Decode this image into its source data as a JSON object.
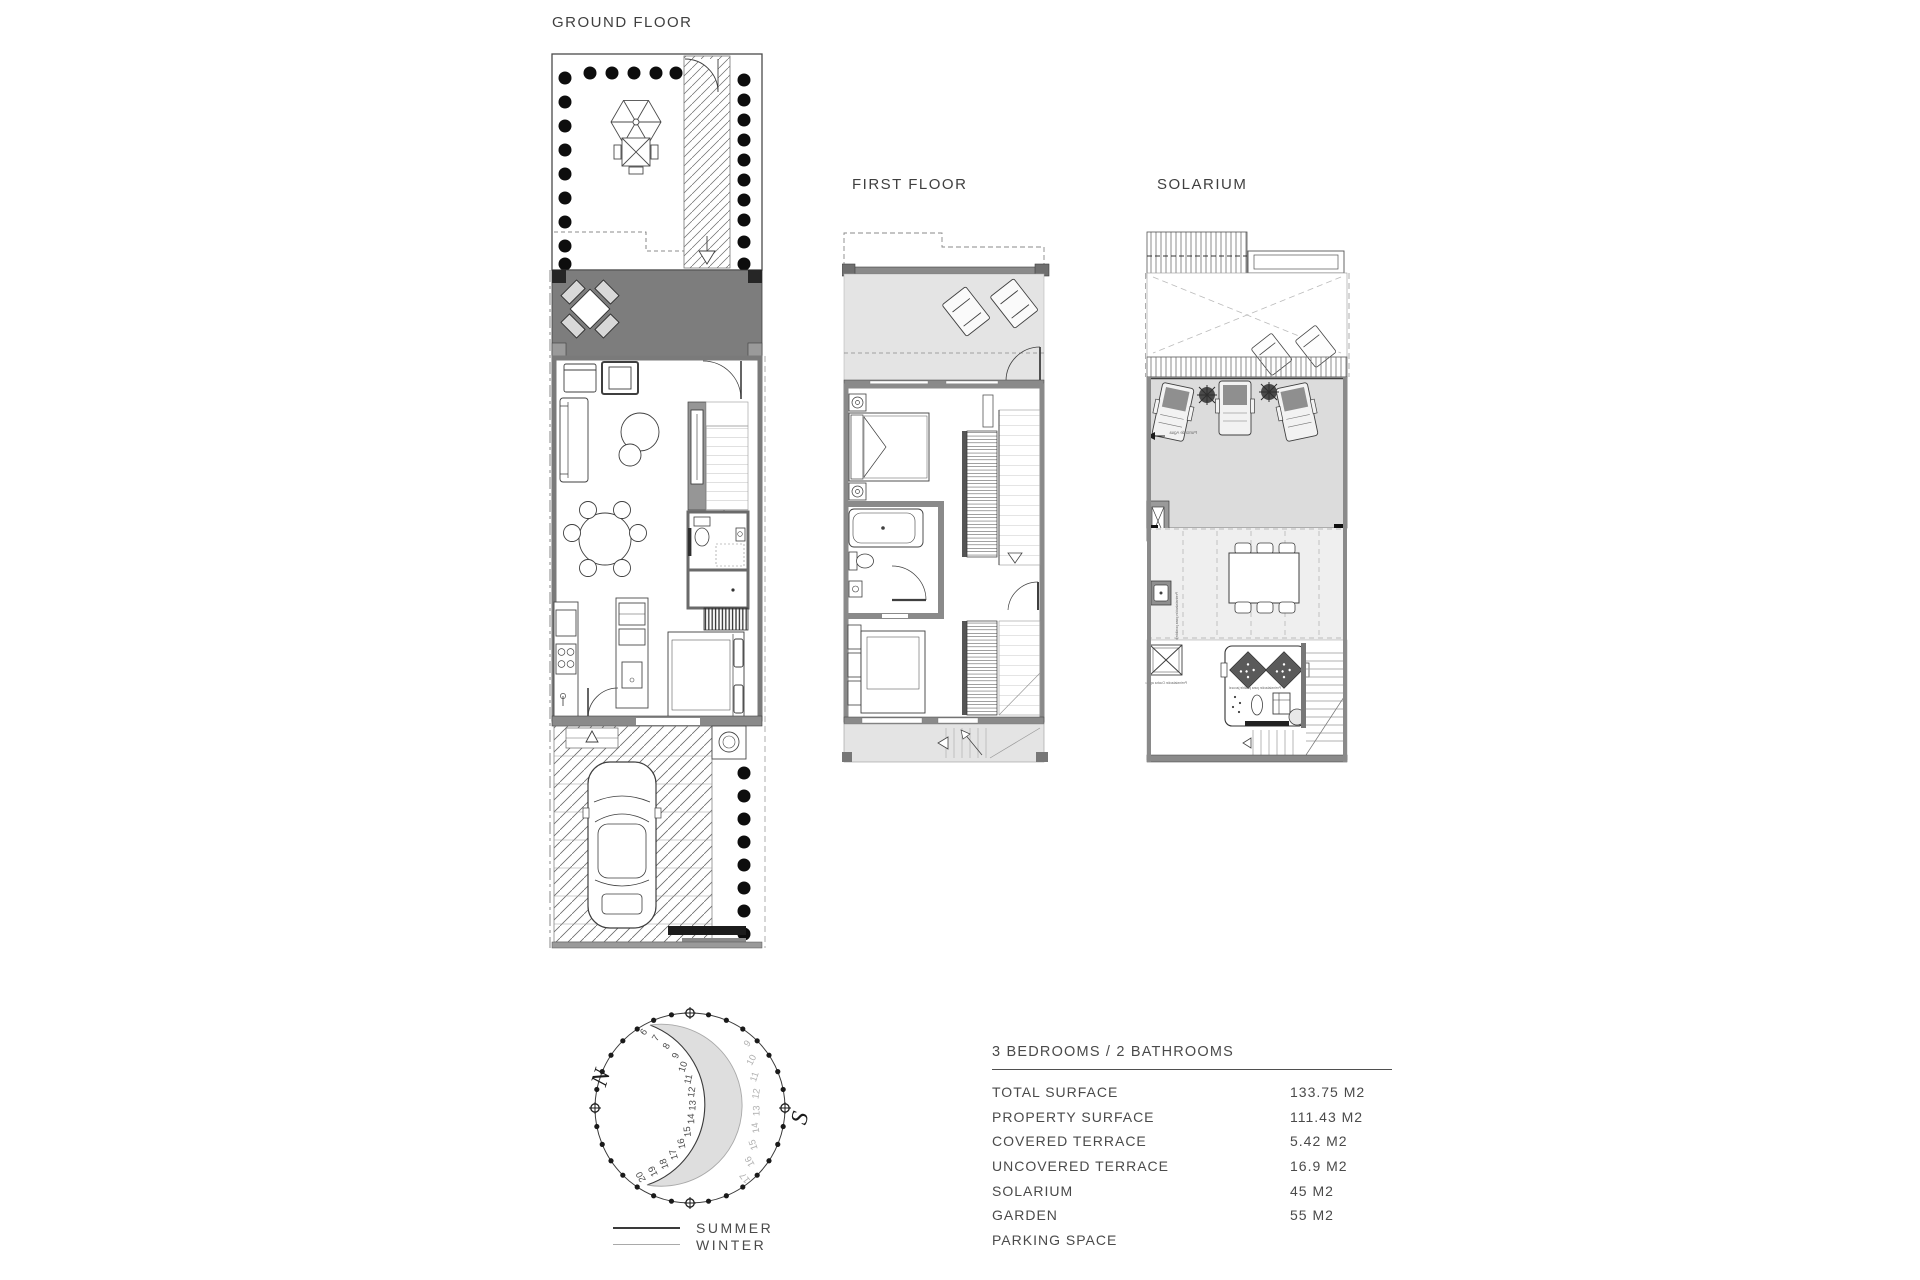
{
  "plans": {
    "ground": {
      "title": "GROUND FLOOR"
    },
    "first": {
      "title": "FIRST FLOOR"
    },
    "solarium": {
      "title": "SOLARIUM",
      "notes": {
        "water_point": "Punto de Agua",
        "barbecue": "Preinstalación para posible barbacoa",
        "jacuzzi": "Preinstalación para posible jacuzzi",
        "shower": "Preinstalación Ducha agua caliente"
      }
    }
  },
  "sun_diagram": {
    "north_label": "N",
    "south_label": "S",
    "summer_hours": [
      6,
      7,
      8,
      9,
      10,
      11,
      12,
      13,
      14,
      15,
      16,
      17,
      18,
      19,
      20
    ],
    "winter_hours": [
      9,
      10,
      11,
      12,
      13,
      14,
      15,
      16,
      17
    ],
    "legend": [
      {
        "label": "SUMMER"
      },
      {
        "label": "WINTER"
      }
    ]
  },
  "specs": {
    "title": "3 BEDROOMS / 2 BATHROOMS",
    "rows": [
      {
        "label": "TOTAL SURFACE",
        "value": "133.75 M2"
      },
      {
        "label": "PROPERTY SURFACE",
        "value": "111.43 M2"
      },
      {
        "label": "COVERED TERRACE",
        "value": "5.42 M2"
      },
      {
        "label": "UNCOVERED TERRACE",
        "value": "16.9 M2"
      },
      {
        "label": "SOLARIUM",
        "value": "45 M2"
      },
      {
        "label": "GARDEN",
        "value": "55 M2"
      },
      {
        "label": "PARKING SPACE",
        "value": ""
      }
    ]
  },
  "colors": {
    "line": "#3f3f3f",
    "wall_gray": "#8a8a8a",
    "covered_terrace": "#7d7d7d",
    "light_area": "#e4e4e4",
    "deck_gray": "#dcdcdc",
    "crescent": "#d8d8d8",
    "text": "#4a4a4a",
    "winter_gray": "#a9a9a9",
    "hedge_dot": "#0d0d0d"
  }
}
